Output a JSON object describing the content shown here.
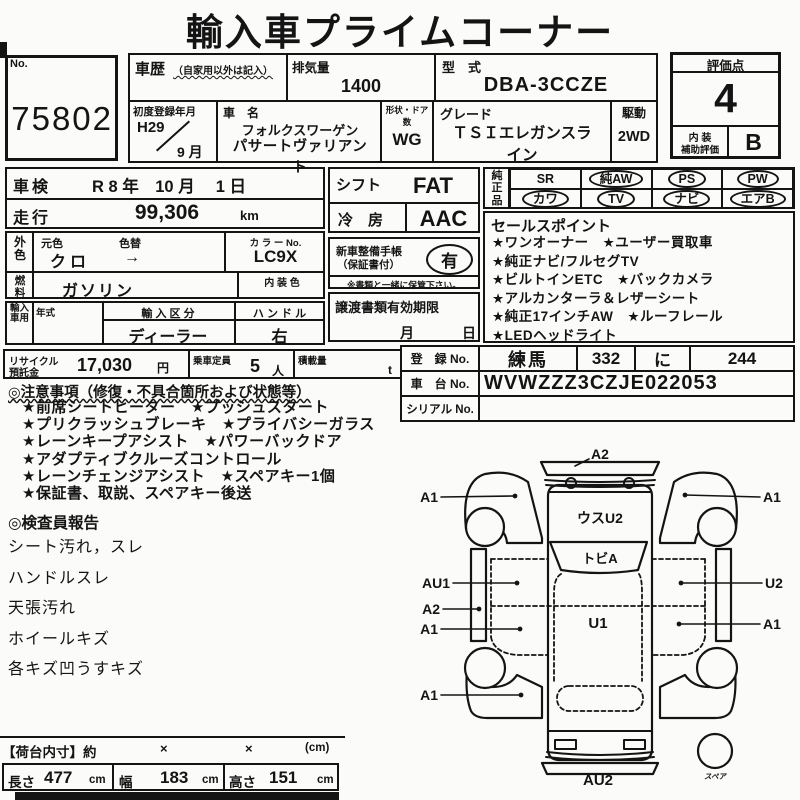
{
  "title": "輸入車プライムコーナー",
  "no_box": {
    "label": "No.",
    "value": "75802"
  },
  "header": {
    "history_label": "車歴",
    "history_note": "（自家用以外は記入）",
    "displacement_label": "排気量",
    "displacement_value": "1400",
    "model_code_label": "型　式",
    "model_code_value": "DBA-3CCZE",
    "first_reg_label": "初度登録年月",
    "first_reg_era": "H29",
    "first_reg_month": "9 月",
    "car_name_label": "車　名",
    "car_name_line1": "フォルクスワーゲン",
    "car_name_line2": "パサートヴァリアント",
    "body_door_label": "形状・ドア数",
    "body_door_value": "WG",
    "grade_label": "グレード",
    "grade_value": "ＴＳＩエレガンスライン",
    "drive_label": "駆動",
    "drive_value": "2WD"
  },
  "rating": {
    "score_label": "評価点",
    "score": "4",
    "interior_line1": "内 装",
    "interior_line2": "補助評価",
    "interior_grade": "B"
  },
  "left_block": {
    "inspection_label": "車検",
    "inspection_value": "R 8 年　10 月　 1 日",
    "mileage_label": "走行",
    "mileage_value": "99,306",
    "mileage_unit": "km",
    "ext_color_label": "外色",
    "orig_color_label": "元色",
    "color_change_label": "色替",
    "orig_color_value": "クロ",
    "color_change_arrow": "→",
    "color_no_label": "カ ラ ー No.",
    "color_no_value": "LC9X",
    "fuel_label": "燃料",
    "fuel_value": "ガソリン",
    "interior_color_label": "内 装 色",
    "import_use_label": "輸入車用",
    "year_label": "年式",
    "import_class_label": "輸 入 区 分",
    "import_class_value": "ディーラー",
    "handle_label": "ハ ン ド ル",
    "handle_value": "右",
    "recycle_label1": "リサイクル",
    "recycle_label2": "預託金",
    "recycle_value": "17,030",
    "recycle_unit": "円",
    "capacity_label": "乗車定員",
    "capacity_value": "5",
    "capacity_unit": "人",
    "load_label": "積載量",
    "load_unit": "t"
  },
  "middle_block": {
    "shift_label": "シフト",
    "shift_value": "FAT",
    "ac_label": "冷　房",
    "ac_value": "AAC",
    "booklet_label1": "新車整備手帳",
    "booklet_label2": "（保証書付）",
    "booklet_value": "有",
    "booklet_note": "※書類と一緒に保管下さい。",
    "transfer_label": "譲渡書類有効期限",
    "transfer_month": "月",
    "transfer_day": "日"
  },
  "oem": {
    "label": "純正品",
    "items": [
      {
        "label": "SR",
        "circled": false
      },
      {
        "label": "純AW",
        "circled": true
      },
      {
        "label": "PS",
        "circled": true
      },
      {
        "label": "PW",
        "circled": true
      },
      {
        "label": "カワ",
        "circled": true
      },
      {
        "label": "TV",
        "circled": true
      },
      {
        "label": "ナビ",
        "circled": true
      },
      {
        "label": "エアB",
        "circled": true
      }
    ]
  },
  "sales_points": {
    "title": "セールスポイント",
    "lines": [
      "★ワンオーナー　★ユーザー買取車",
      "★純正ナビ/フルセグTV",
      "★ビルトインETC　★バックカメラ",
      "★アルカンターラ＆レザーシート",
      "★純正17インチAW　★ルーフレール",
      "★LEDヘッドライト"
    ]
  },
  "registration": {
    "reg_label": "登　録 No.",
    "reg_area": "練馬",
    "reg_class": "332",
    "reg_kana": "に",
    "reg_number": "244",
    "chassis_label": "車　台 No.",
    "chassis_value": "WVWZZZ3CZJE022053",
    "serial_label": "シリアル No.",
    "serial_value": ""
  },
  "notes": {
    "title": "◎注意事項（修復・不具合箇所および状態等）",
    "lines": [
      "★前席シートヒーター　★プッシュスタート",
      "★プリクラッシュブレーキ　★プライバシーガラス",
      "★レーンキープアシスト　★パワーバックドア",
      "★アダプティブクルーズコントロール",
      "★レーンチェンジアシスト　★スペアキー1個",
      "★保証書、取説、スペアキー後送"
    ]
  },
  "inspector_report": {
    "title": "◎検査員報告",
    "lines": [
      "シート汚れ，スレ",
      "ハンドルスレ",
      "天張汚れ",
      "ホイールキズ",
      "各キズ凹うすキズ"
    ]
  },
  "diagram": {
    "top_label": "A2",
    "bottom_label": "AU2",
    "hood_label": "ウスU2",
    "windshield_label": "トビA",
    "cabin_label": "U1",
    "spare_label": "スペア",
    "left_labels": [
      "A1",
      "AU1",
      "A2",
      "A1",
      "A1"
    ],
    "right_labels": [
      "A1",
      "U2",
      "A1"
    ]
  },
  "cargo": {
    "header": "【荷台内寸】約",
    "sep1": "×",
    "sep2": "×",
    "unit": "(cm)",
    "length_label": "長さ",
    "length_value": "477",
    "length_unit": "cm",
    "width_label": "幅",
    "width_value": "183",
    "width_unit": "cm",
    "height_label": "高さ",
    "height_value": "151",
    "height_unit": "cm"
  }
}
